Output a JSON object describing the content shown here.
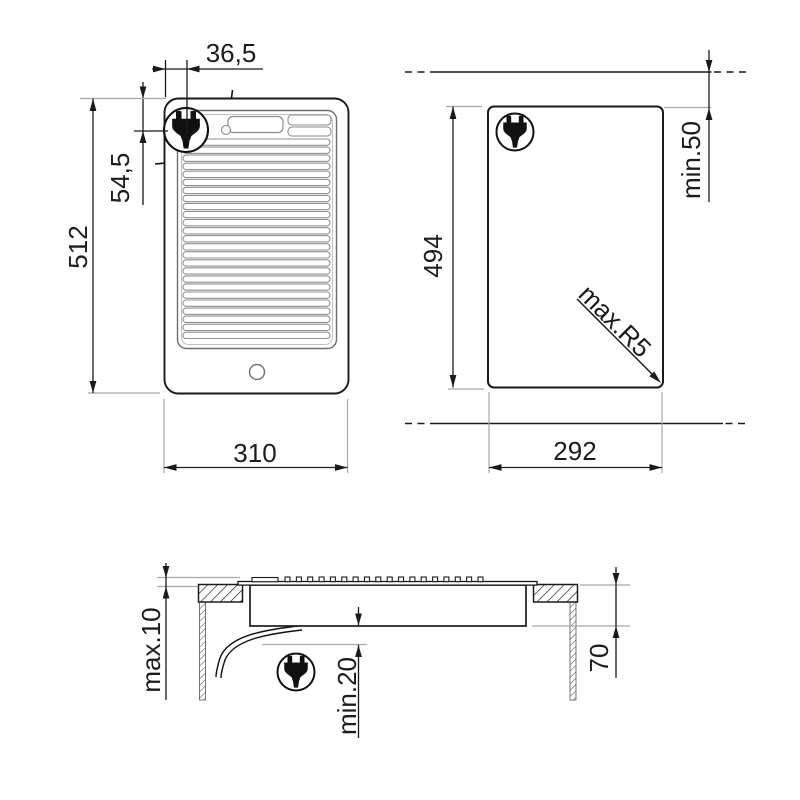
{
  "drawing": {
    "kind": "appliance installation drawing",
    "colors": {
      "background": "#ffffff",
      "line": "#1a1a1a",
      "reference": "#a8a8a8",
      "detail": "#8c8c8c"
    },
    "views": {
      "front": {
        "dims": {
          "plug_side_offset": "36,5",
          "plug_top_offset": "54,5",
          "height": "512",
          "width": "310"
        }
      },
      "cutout": {
        "dims": {
          "height": "494",
          "rear_clearance": "min.50",
          "corner_radius": "max.R5",
          "width": "292"
        }
      },
      "section": {
        "dims": {
          "above_counter": "max.10",
          "cable_clearance": "min.20",
          "recess_depth": "70"
        }
      }
    },
    "icons": {
      "plug": "power-plug-icon"
    }
  }
}
